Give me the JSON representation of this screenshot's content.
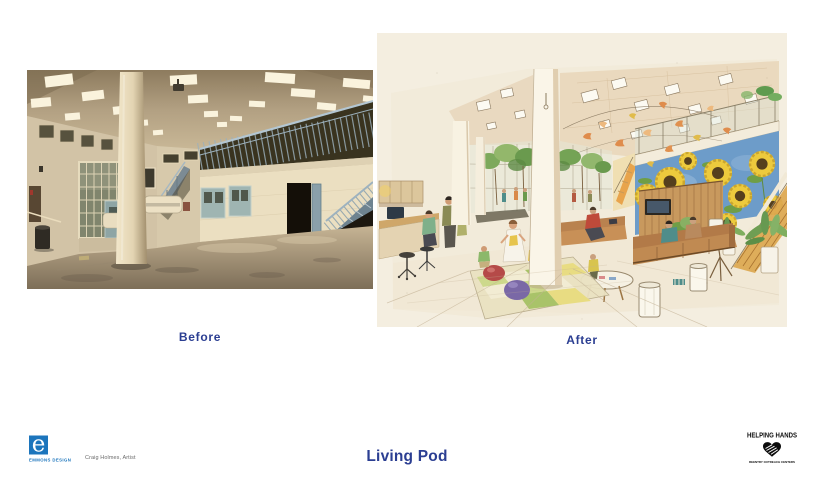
{
  "slide": {
    "title": "Living Pod",
    "background_color": "#ffffff",
    "accent_text_color": "#2b3e92"
  },
  "comparison": {
    "before": {
      "label": "Before",
      "alt": "Photograph of existing day room: tall beige institutional hall, fluorescent ceiling lights, large cream column, gridded window wall, dark mezzanine with blue-gray railings, cell doors and metal stairs, bare concrete floor"
    },
    "after": {
      "label": "After",
      "alt": "Watercolor concept sketch of renovated living pod: sunflower mural, hanging paper-bird mobile, indoor trees, wood slat wall with TV, sofas around a round table, children playing on a checkered rug, plants and reception desk"
    }
  },
  "footer": {
    "emmons_design": {
      "logo_letter": "e",
      "wordmark": "EMMONS DESIGN",
      "brand_color": "#1c75bc"
    },
    "artist_credit": "Craig Holmes, Artist",
    "helping_hands": {
      "wordmark": "HELPING HANDS",
      "tagline": "REENTRY OUTREACH CENTERS",
      "icon": "handshake-heart-icon",
      "brand_color": "#0b0b0b"
    }
  }
}
